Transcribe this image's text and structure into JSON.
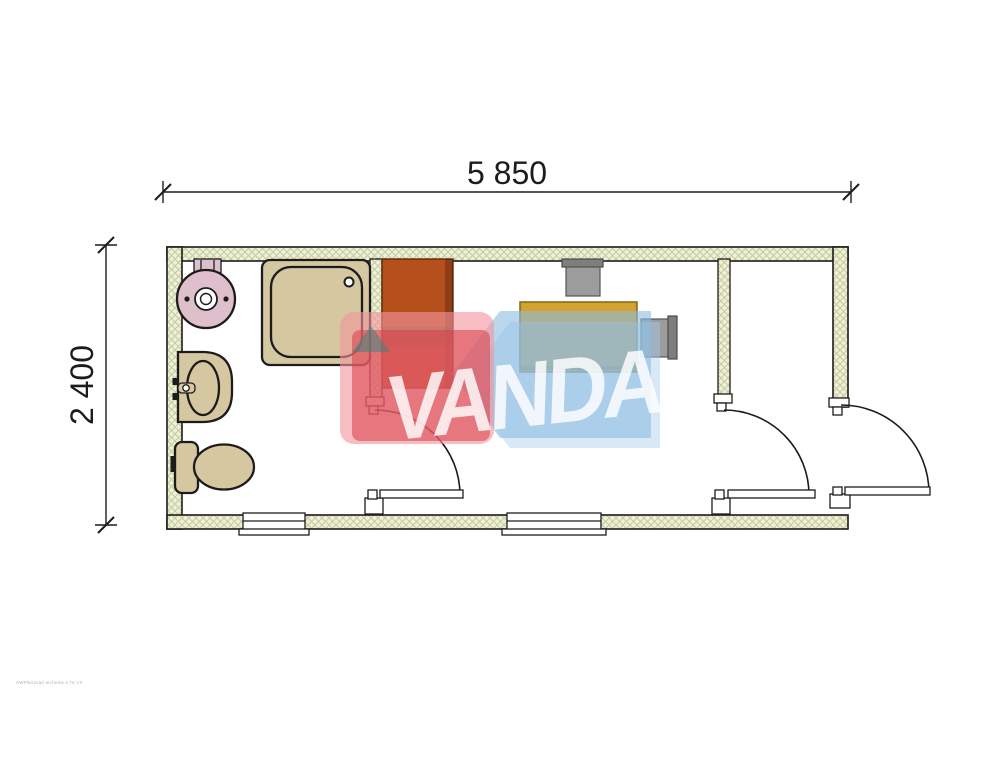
{
  "drawing": {
    "type": "floor-plan",
    "rooms": [
      "bathroom",
      "office",
      "entry-vestibule"
    ],
    "fixture_names": [
      "water-heater",
      "shower-tray",
      "washbasin",
      "toilet",
      "wardrobe",
      "desk",
      "chair",
      "chair",
      "interior-door",
      "interior-door",
      "exterior-door",
      "window",
      "window"
    ]
  },
  "dimensions": {
    "width_label": "5 850",
    "height_label": "2 400"
  },
  "watermark": {
    "text": "VANDA",
    "microtext": "SWPlan2cad technika 4.76 VX"
  },
  "colors": {
    "ink": "#1c1c1c",
    "hatch_bg": "#eef0d8",
    "hatch_line": "#c6c99b",
    "floor": "#ffffff",
    "fixture": "#d5c8a0",
    "boiler": "#debfcb",
    "bracket": "#d9c2cc",
    "wardrobe": "#b5501d",
    "wardrobe_edge": "rgba(0,0,0,0.22)",
    "wardrobe_band": "rgba(60,55,35,0.35)",
    "desk": "#c8992b",
    "desk_top": "#d2a42e",
    "desk_shade": "rgba(0,0,0,0.18)",
    "chair": "#9c9c9c",
    "chair_back": "#7e7e7e",
    "wm_blue": "rgba(140,188,226,0.60)",
    "wm_blue_light": "rgba(170,205,235,0.45)",
    "wm_red_outer": "rgba(242,148,156,0.62)",
    "wm_red_inner": "rgba(217,62,72,0.55)",
    "wm_teal": "rgba(45,138,128,0.50)",
    "wm_text": "rgba(255,255,255,0.82)"
  }
}
